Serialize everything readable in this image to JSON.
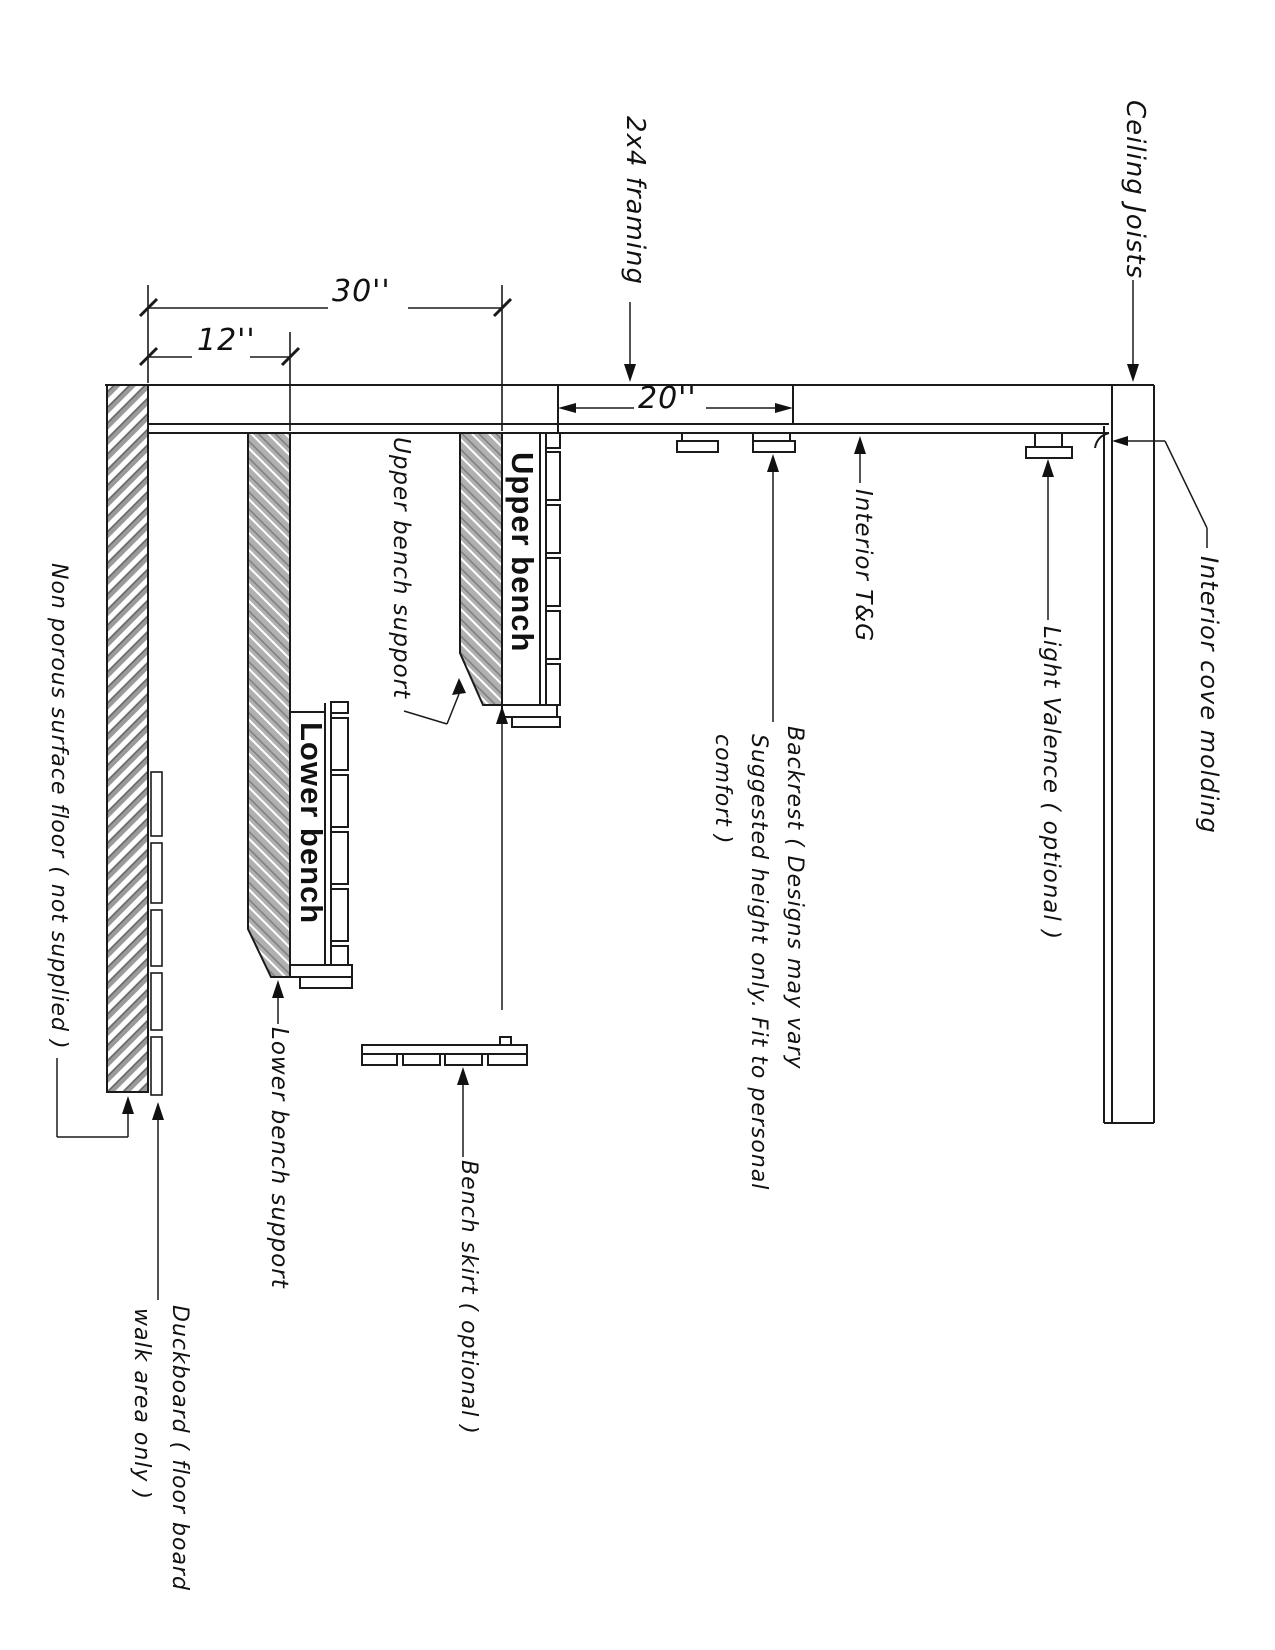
{
  "drawing": {
    "kind": "sauna-bench-section-diagram",
    "labels": {
      "ceiling_joists": "Ceiling Joists",
      "framing_2x4": "2x4 framing",
      "interior_tg": "Interior T&G",
      "light_valence": "Light Valence ( optional )",
      "interior_cove_molding": "Interior cove molding",
      "backrest_line1": "Backrest ( Designs may vary",
      "backrest_line2": "Suggested height only. Fit to personal",
      "backrest_line3": "comfort )",
      "upper_bench": "Upper bench",
      "lower_bench": "Lower bench",
      "upper_bench_support": "Upper bench support",
      "lower_bench_support": "Lower bench support",
      "bench_skirt": "Bench skirt ( optional )",
      "non_porous_floor": "Non porous surface floor ( not supplied )",
      "duckboard_line1": "Duckboard ( floor board",
      "duckboard_line2": "walk area only )"
    },
    "dimensions": {
      "d30": "30''",
      "d12": "12''",
      "d20": "20''"
    },
    "colors": {
      "line": "#1a1a1a",
      "hatch_gray": "#9a9a9a",
      "background": "#ffffff"
    }
  }
}
